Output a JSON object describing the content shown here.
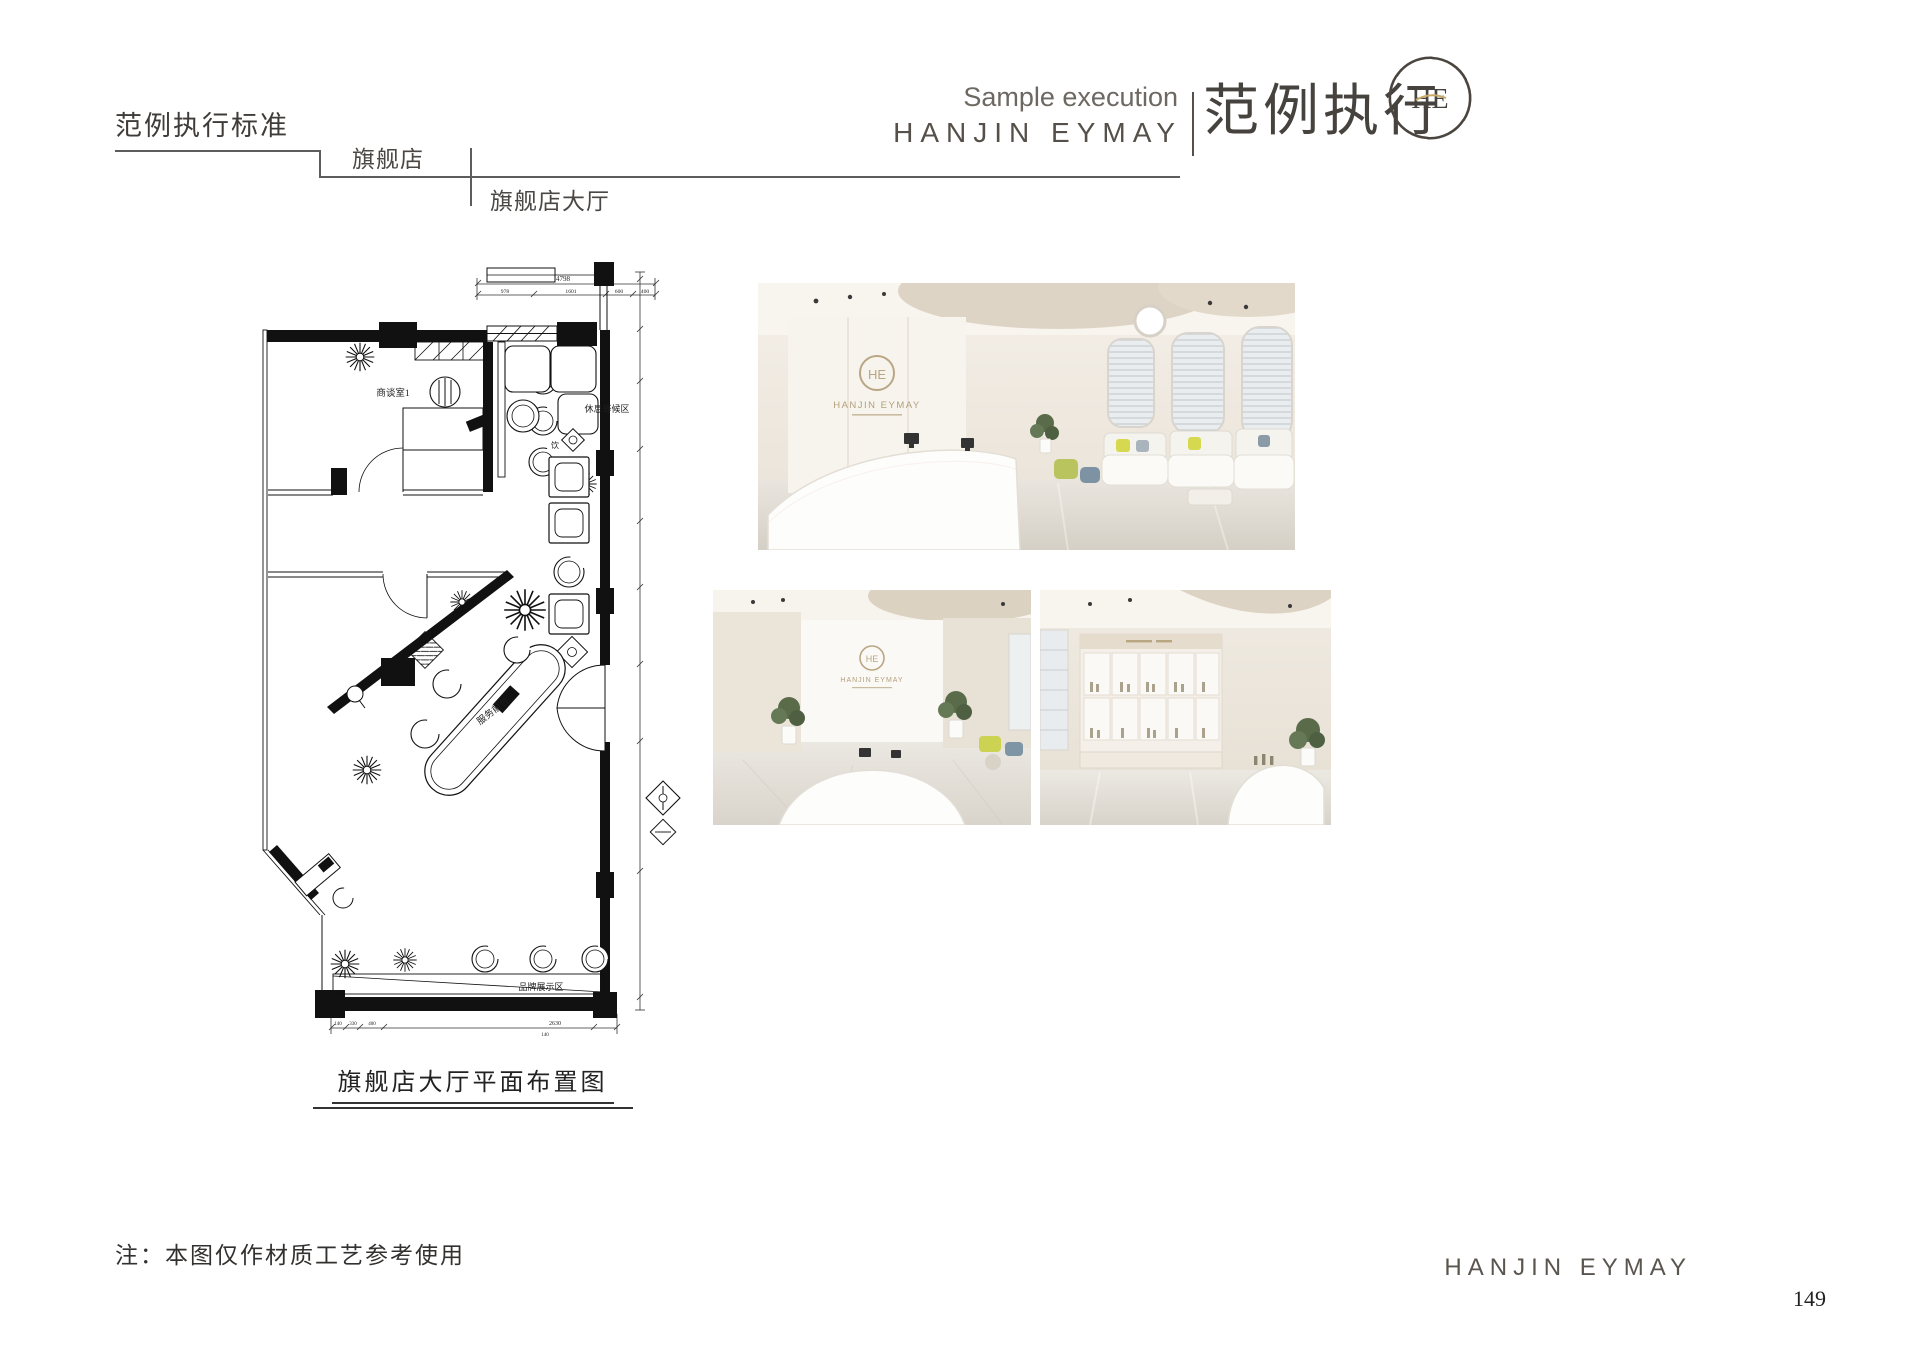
{
  "header": {
    "section_title": "范例执行标准",
    "breadcrumb_level1": "旗舰店",
    "breadcrumb_level2": "旗舰店大厅",
    "sample_execution_en": "Sample execution",
    "brand_en": "HANJIN EYMAY",
    "sample_execution_cn": "范例执行",
    "logo_monogram": "HE"
  },
  "floor_plan": {
    "caption": "旗舰店大厅平面布置图",
    "labels": {
      "meeting_room": "商谈室1",
      "bar": "吧台",
      "waiting_area": "休息等候区",
      "drink_station": "饮",
      "service_desk": "服务前台",
      "brand_display": "品牌展示区"
    },
    "dimensions": {
      "top_total": "4798",
      "top_segments": [
        "978",
        "1601",
        "600",
        "400"
      ],
      "bottom_segments": [
        "140",
        "330",
        "400",
        "2630",
        "140"
      ]
    }
  },
  "renders": {
    "main": {
      "logo_text": "HANJIN EYMAY",
      "logo_monogram": "HE"
    },
    "reception": {
      "logo_text": "HANJIN EYMAY",
      "logo_monogram": "HE"
    },
    "display": {}
  },
  "footer": {
    "note": "注：本图仅作材质工艺参考使用",
    "brand_en": "HANJIN EYMAY",
    "page_number": "149"
  }
}
